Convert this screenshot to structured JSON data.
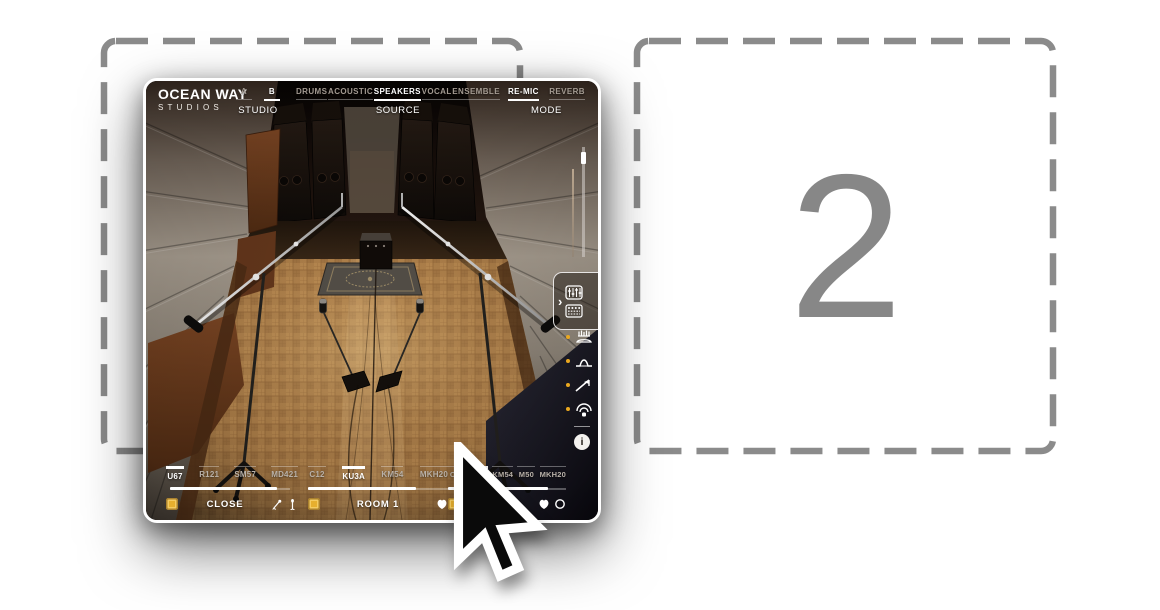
{
  "step": {
    "number": "2"
  },
  "plugin": {
    "logo": {
      "line1": "OCEAN WAY",
      "line2": "STUDIOS"
    },
    "header": {
      "studio": {
        "label": "STUDIO",
        "options": [
          {
            "label": "A",
            "selected": false
          },
          {
            "label": "B",
            "selected": true
          }
        ]
      },
      "source": {
        "label": "SOURCE",
        "options": [
          {
            "label": "DRUMS",
            "selected": false
          },
          {
            "label": "ACOUSTIC",
            "selected": false
          },
          {
            "label": "SPEAKERS",
            "selected": true
          },
          {
            "label": "VOCAL",
            "selected": false
          },
          {
            "label": "ENSEMBLE",
            "selected": false
          }
        ]
      },
      "mode": {
        "label": "MODE",
        "options": [
          {
            "label": "RE-MIC",
            "selected": true
          },
          {
            "label": "REVERB",
            "selected": false
          }
        ]
      }
    },
    "side": {
      "chevron": "›",
      "info_glyph": "i"
    },
    "mic_groups": [
      {
        "name": "CLOSE",
        "level_pct": 89,
        "mics": [
          {
            "label": "U67",
            "selected": true
          },
          {
            "label": "R121",
            "selected": false
          },
          {
            "label": "SM57",
            "selected": false
          },
          {
            "label": "MD421",
            "selected": false
          }
        ]
      },
      {
        "name": "ROOM 1",
        "level_pct": 77,
        "mics": [
          {
            "label": "C12",
            "selected": false
          },
          {
            "label": "KU3A",
            "selected": true
          },
          {
            "label": "KM54",
            "selected": false
          },
          {
            "label": "MKH20",
            "selected": false
          }
        ]
      },
      {
        "name": "ROOM 2",
        "level_pct": 85,
        "mics": [
          {
            "label": "C12",
            "selected": false
          },
          {
            "label": "U47",
            "selected": true
          },
          {
            "label": "KM54",
            "selected": false
          },
          {
            "label": "M50",
            "selected": false
          },
          {
            "label": "MKH20",
            "selected": false
          }
        ]
      }
    ]
  },
  "colors": {
    "accent_yellow": "#e6af2e",
    "dash_gray": "#8b8b8b",
    "step_gray": "#878787"
  }
}
